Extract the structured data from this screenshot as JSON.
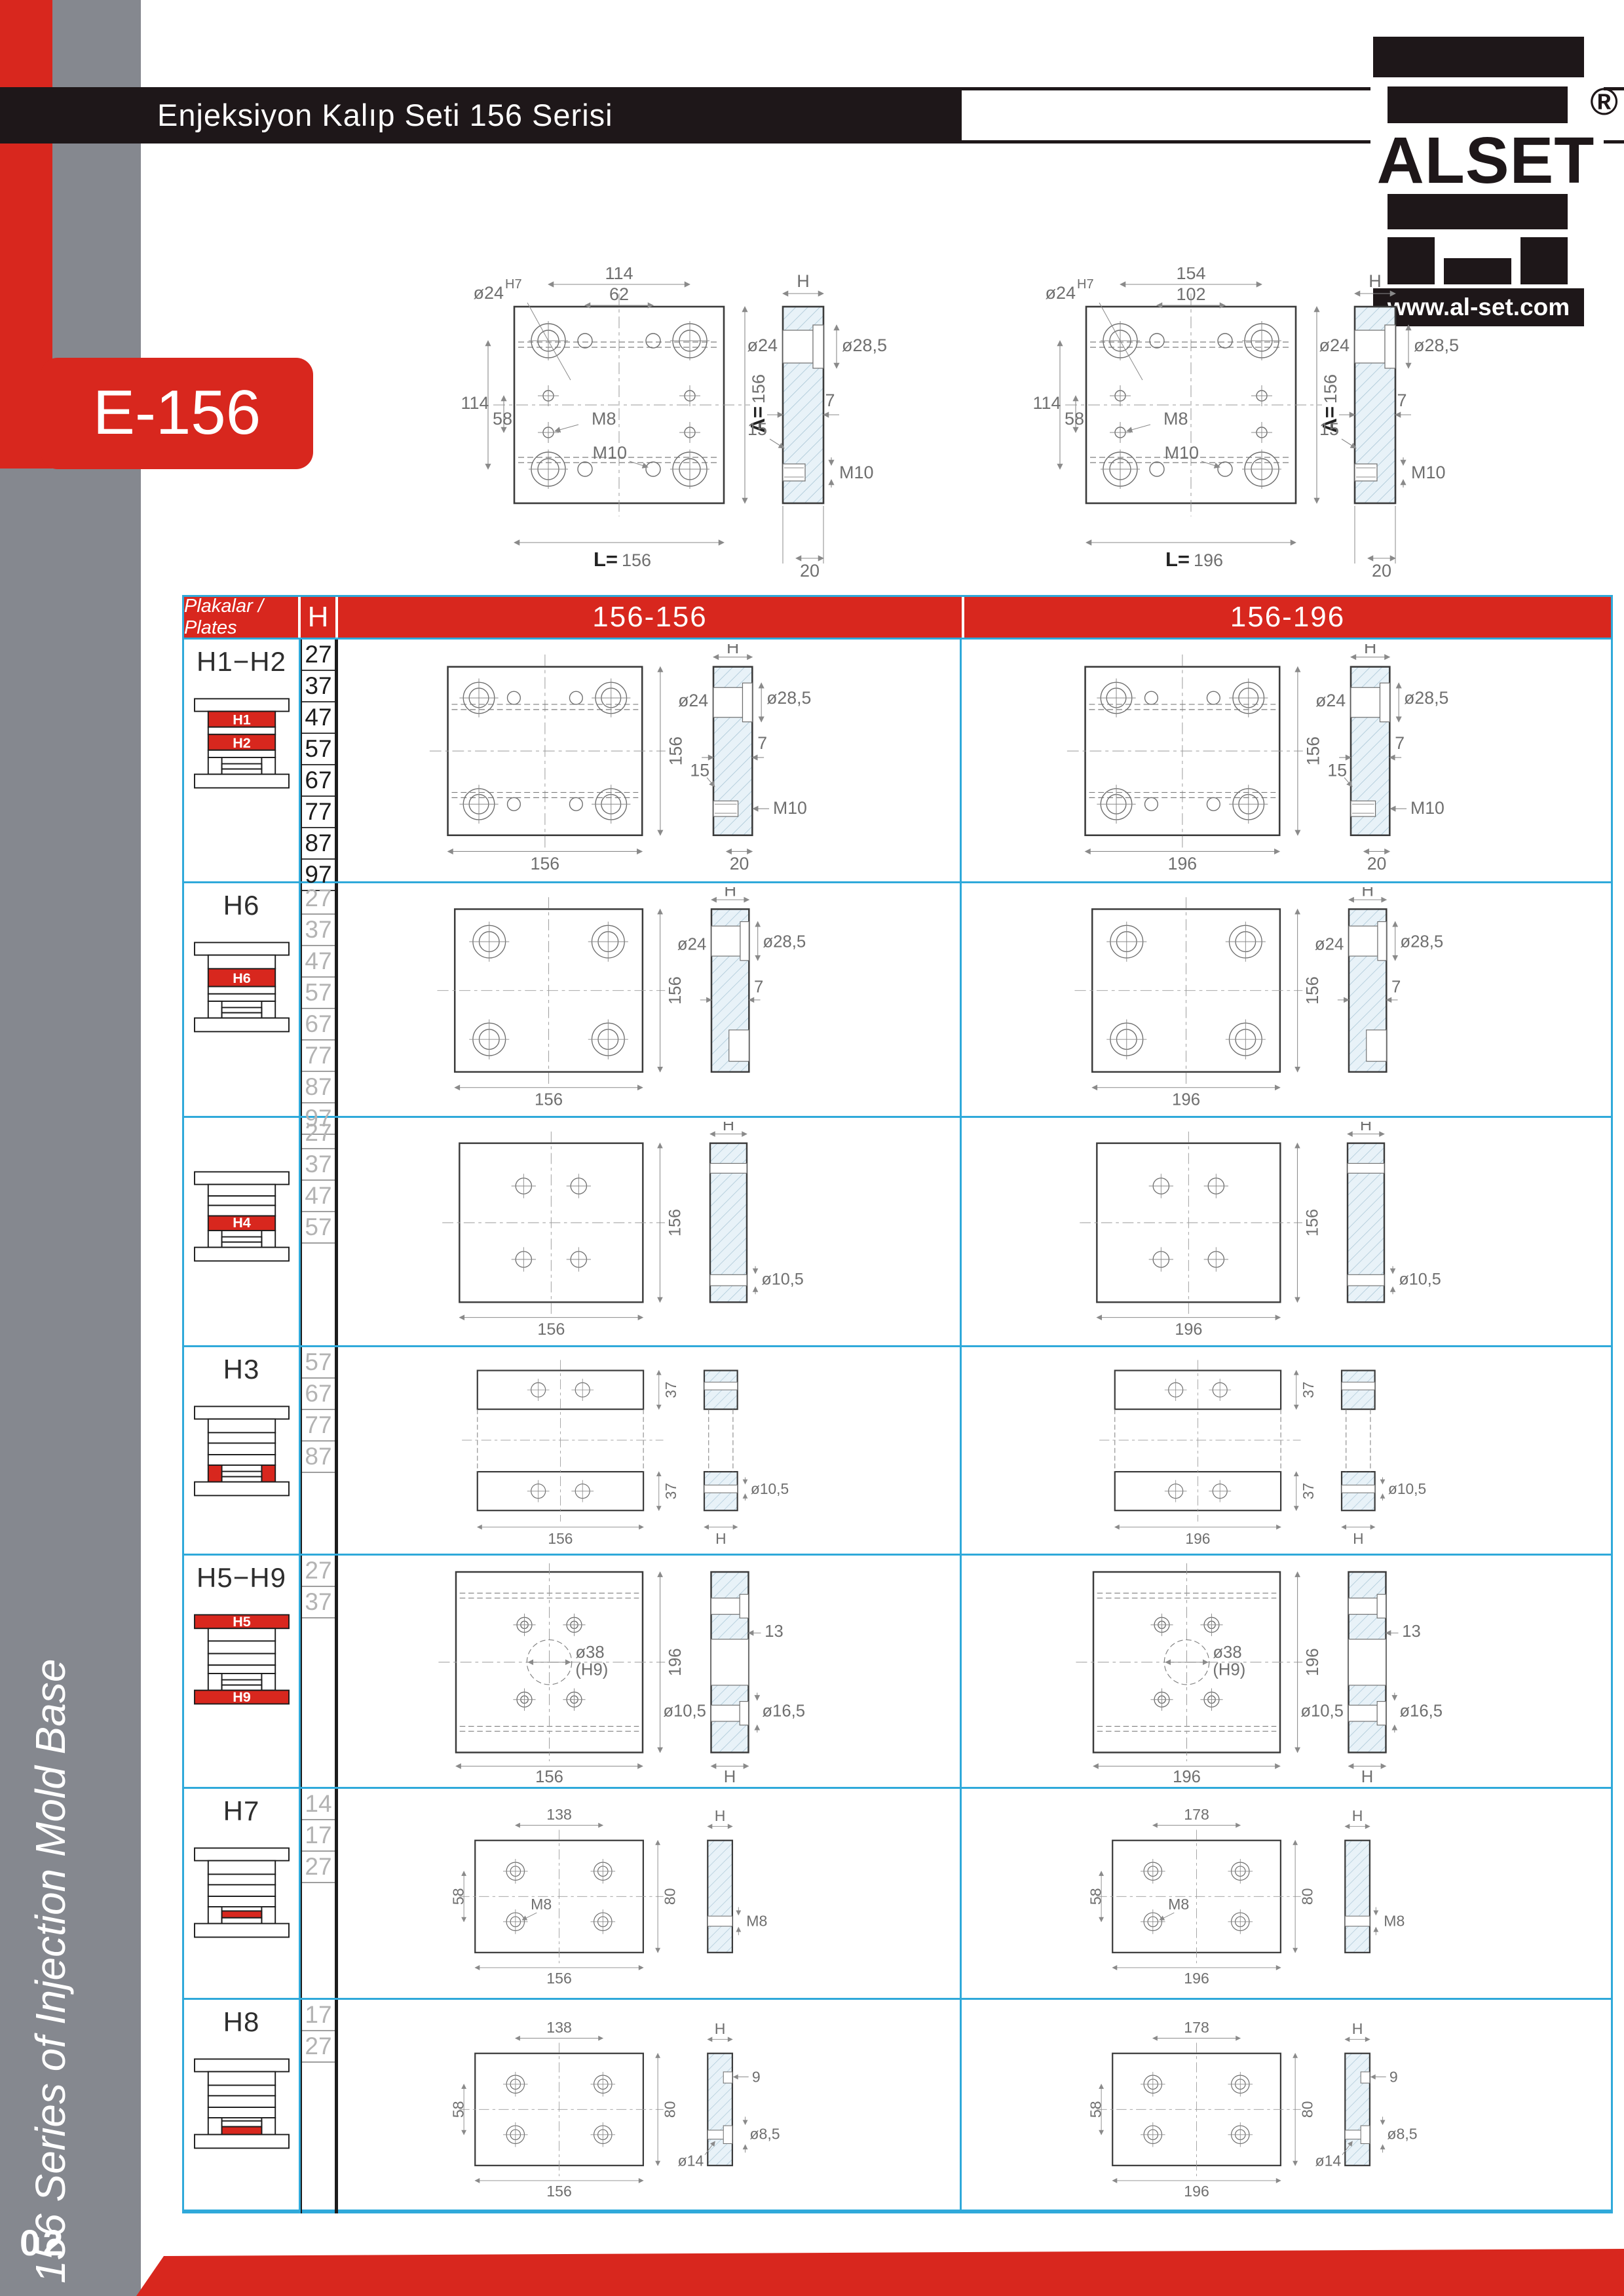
{
  "page": {
    "title": "Enjeksiyon Kalıp Seti 156 Serisi",
    "badge": "E-156",
    "sidebar_vertical_text": "156 Series of Injection Mold Base",
    "page_number": "02",
    "logo": {
      "brand": "ALSET",
      "registered": "®",
      "website": "www.al-set.com"
    }
  },
  "colors": {
    "red": "#D8271E",
    "table_border_blue": "#2FA9DA",
    "sidebar_gray": "#85888F",
    "header_black": "#1E1719"
  },
  "top_drawings": {
    "left": {
      "top": "114",
      "inner": "62",
      "hole": "ø24",
      "tol": "H7",
      "l114": "114",
      "l58": "58",
      "m8": "M8",
      "m10": "M10",
      "bp": "L=",
      "bv": "156",
      "rp": "A=",
      "rv": "156",
      "h": "H",
      "d24": "ø24",
      "d285": "ø28,5",
      "n7": "7",
      "n15": "15",
      "m10s": "M10",
      "n20": "20"
    },
    "right": {
      "top": "154",
      "inner": "102",
      "hole": "ø24",
      "tol": "H7",
      "l114": "114",
      "l58": "58",
      "m8": "M8",
      "m10": "M10",
      "bp": "L=",
      "bv": "196",
      "rp": "A=",
      "rv": "156",
      "h": "H",
      "d24": "ø24",
      "d285": "ø28,5",
      "n7": "7",
      "n15": "15",
      "m10s": "M10",
      "n20": "20"
    }
  },
  "table": {
    "header": {
      "plates": "Plakalar / Plates",
      "h": "H",
      "col1": "156-156",
      "col2": "156-196"
    },
    "rows": [
      {
        "label": "H1−H2",
        "h_values": [
          "27",
          "37",
          "47",
          "57",
          "67",
          "77",
          "87",
          "97"
        ],
        "icon": {
          "top": "H1",
          "bottom": "H2"
        },
        "labels": {
          "right": "156",
          "h": "H",
          "d24": "ø24",
          "d285": "ø28,5",
          "n7": "7",
          "n15": "15",
          "m10": "M10",
          "n20": "20"
        },
        "c1": {
          "bottom": "156"
        },
        "c2": {
          "bottom": "196"
        }
      },
      {
        "label": "H6",
        "h_values": [
          "27",
          "37",
          "47",
          "57",
          "67",
          "77",
          "87",
          "97"
        ],
        "icon": {
          "top": "H6"
        },
        "labels": {
          "right": "156",
          "h": "H",
          "d24": "ø24",
          "d285": "ø28,5",
          "n7": "7"
        },
        "c1": {
          "bottom": "156"
        },
        "c2": {
          "bottom": "196"
        }
      },
      {
        "label": "",
        "h_values": [
          "27",
          "37",
          "47",
          "57"
        ],
        "icon": {
          "top": "H4"
        },
        "labels": {
          "right": "156",
          "h": "H",
          "d105": "ø10,5"
        },
        "c1": {
          "bottom": "156"
        },
        "c2": {
          "bottom": "196"
        }
      },
      {
        "label": "H3",
        "h_values": [
          "57",
          "67",
          "77",
          "87"
        ],
        "icon": {},
        "labels": {
          "t37": "37",
          "b37": "37",
          "d105": "ø10,5",
          "h": "H"
        },
        "c1": {
          "bottom": "156"
        },
        "c2": {
          "bottom": "196"
        }
      },
      {
        "label": "H5−H9",
        "h_values": [
          "27",
          "37"
        ],
        "icon": {
          "top": "H5",
          "bottom": "H9"
        },
        "labels": {
          "right": "196",
          "h": "H",
          "d38": "ø38",
          "h9": "(H9)",
          "n13": "13",
          "d105": "ø10,5",
          "d165": "ø16,5"
        },
        "c1": {
          "bottom": "156"
        },
        "c2": {
          "bottom": "196"
        }
      },
      {
        "label": "H7",
        "h_values": [
          "14",
          "17",
          "27"
        ],
        "icon": {},
        "labels": {
          "left": "58",
          "right": "80",
          "m8": "M8",
          "h": "H",
          "m8s": "M8"
        },
        "c1": {
          "bottom": "156",
          "top": "138"
        },
        "c2": {
          "bottom": "196",
          "top": "178"
        }
      },
      {
        "label": "H8",
        "h_values": [
          "17",
          "27"
        ],
        "icon": {},
        "labels": {
          "left": "58",
          "right": "80",
          "h": "H",
          "n9": "9",
          "d14": "ø14",
          "d85": "ø8,5"
        },
        "c1": {
          "bottom": "156",
          "top": "138"
        },
        "c2": {
          "bottom": "196",
          "top": "178"
        }
      }
    ]
  }
}
